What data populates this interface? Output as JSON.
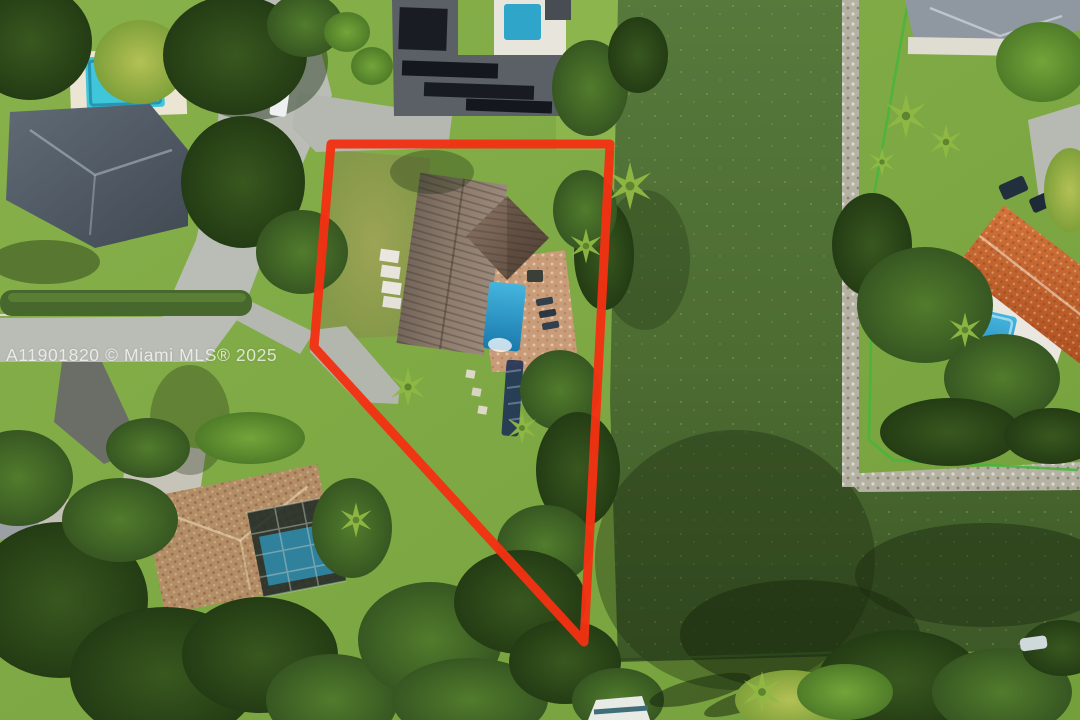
{
  "photo": {
    "kind": "aerial-drone-real-estate-photo",
    "subject": "waterfront lot outlined in red beside a canal"
  },
  "watermark": {
    "text": "A11901820 © Miami MLS® 2025"
  },
  "boundary": {
    "points": "331,144 610,144 584,642 314,347",
    "color": "#f23113",
    "stroke_width": 9
  },
  "palette": {
    "lawn": "#82ab46",
    "lawn_bright": "#8fb84f",
    "dry_grass": "#99a155",
    "canal_water": "#4e7035",
    "canal_water_dark": "#35501f",
    "rock_bank": "#b5b2a3",
    "road": "#b9bdb5",
    "asphalt": "#6a6e66",
    "subject_roof": "#81705f",
    "subject_roof_wing": "#6e5949",
    "pool_blue": "#2f9fd0",
    "pool_teal": "#3fc4d8",
    "paver_deck": "#c99c79",
    "slate_roof": "#545e69",
    "solar_panel": "#191d23",
    "old_tile_roof": "#b28d66",
    "orange_tile_roof": "#c express6231",
    "white_deck": "#e9e7e0",
    "boundary_red": "#f23113",
    "tree_dark": "#2c471b",
    "tree_mid": "#47702a",
    "fence_green": "#46b53c"
  }
}
